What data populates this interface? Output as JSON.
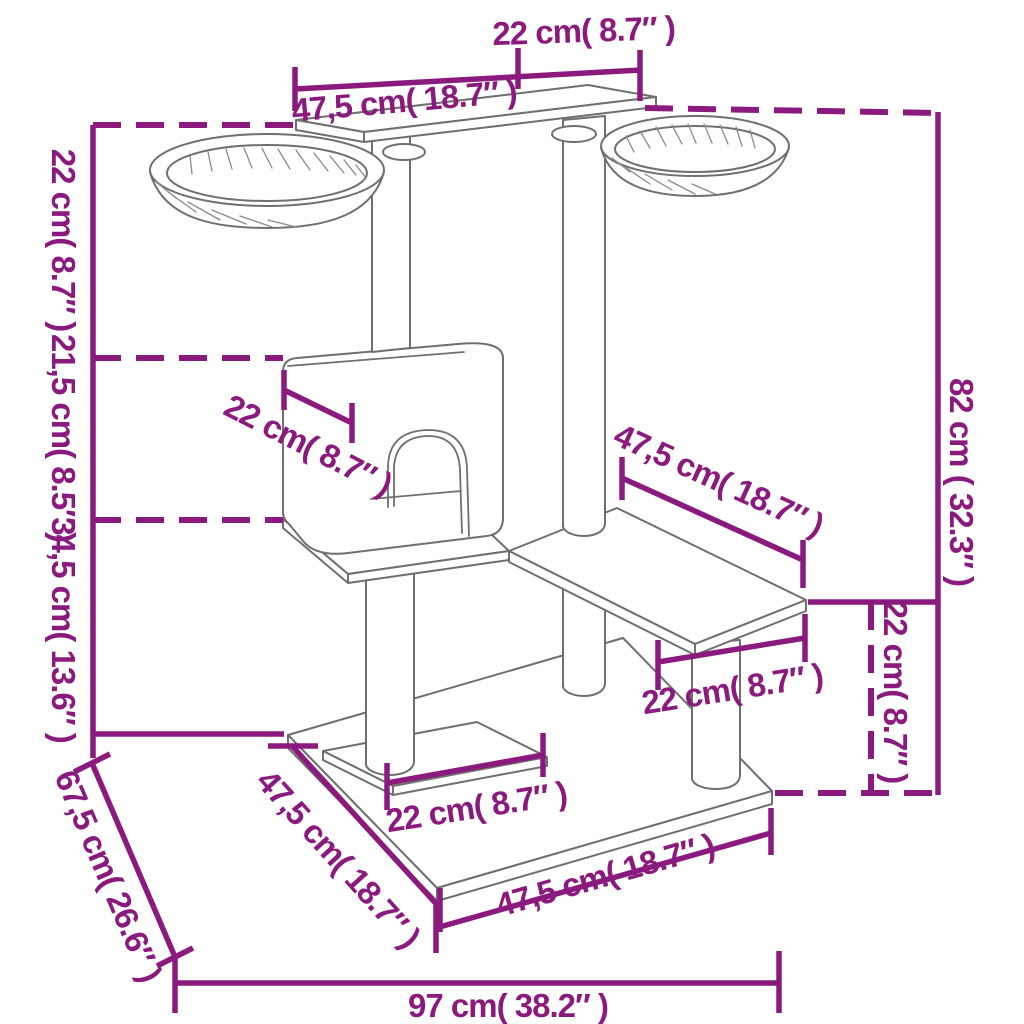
{
  "diagram": {
    "kind": "product-dimension-diagram",
    "subject": "cat tree with condo, platforms and two bowl perches",
    "accent_color": "#8B1A7E",
    "drawing_color": "#6F6F6F"
  },
  "dimensions": {
    "top_width": "22 cm( 8.7″ )",
    "top_length": "47,5 cm( 18.7″ )",
    "upper_height": "22 cm( 8.7″ )",
    "house_height": "21,5 cm( 8.5″ )",
    "lower_height": "34,5 cm( 13.6″ )",
    "base_depth": "67,5 cm( 26.6″ )",
    "overall_width": "97 cm( 38.2″ )",
    "overall_height": "82 cm ( 32.3″ )",
    "platform_drop": "22 cm( 8.7″ )",
    "house_width": "22 cm( 8.7″ )",
    "mid_platform_length": "47,5 cm( 18.7″ )",
    "mid_platform_width": "22 cm( 8.7″ )",
    "base_inner_width": "22 cm( 8.7″ )",
    "base_side_length": "47,5 cm( 18.7″ )",
    "base_front_length": "47,5 cm( 18.7″ )"
  }
}
